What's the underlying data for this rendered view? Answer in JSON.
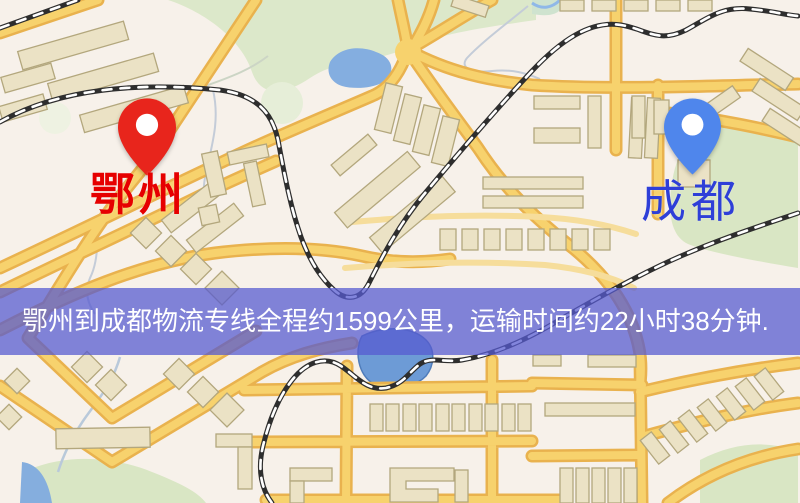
{
  "map": {
    "origin": {
      "label": "鄂州",
      "pin_color": "#e8251c",
      "label_color": "#e60000"
    },
    "destination": {
      "label": "成都",
      "pin_color": "#4f86ec",
      "label_color": "#2e3fd8"
    },
    "banner": {
      "text": "鄂州到成都物流专线全程约1599公里，运输时间约22小时38分钟.",
      "background": "rgba(86,90,208,0.74)",
      "text_color": "#ffffff"
    }
  }
}
